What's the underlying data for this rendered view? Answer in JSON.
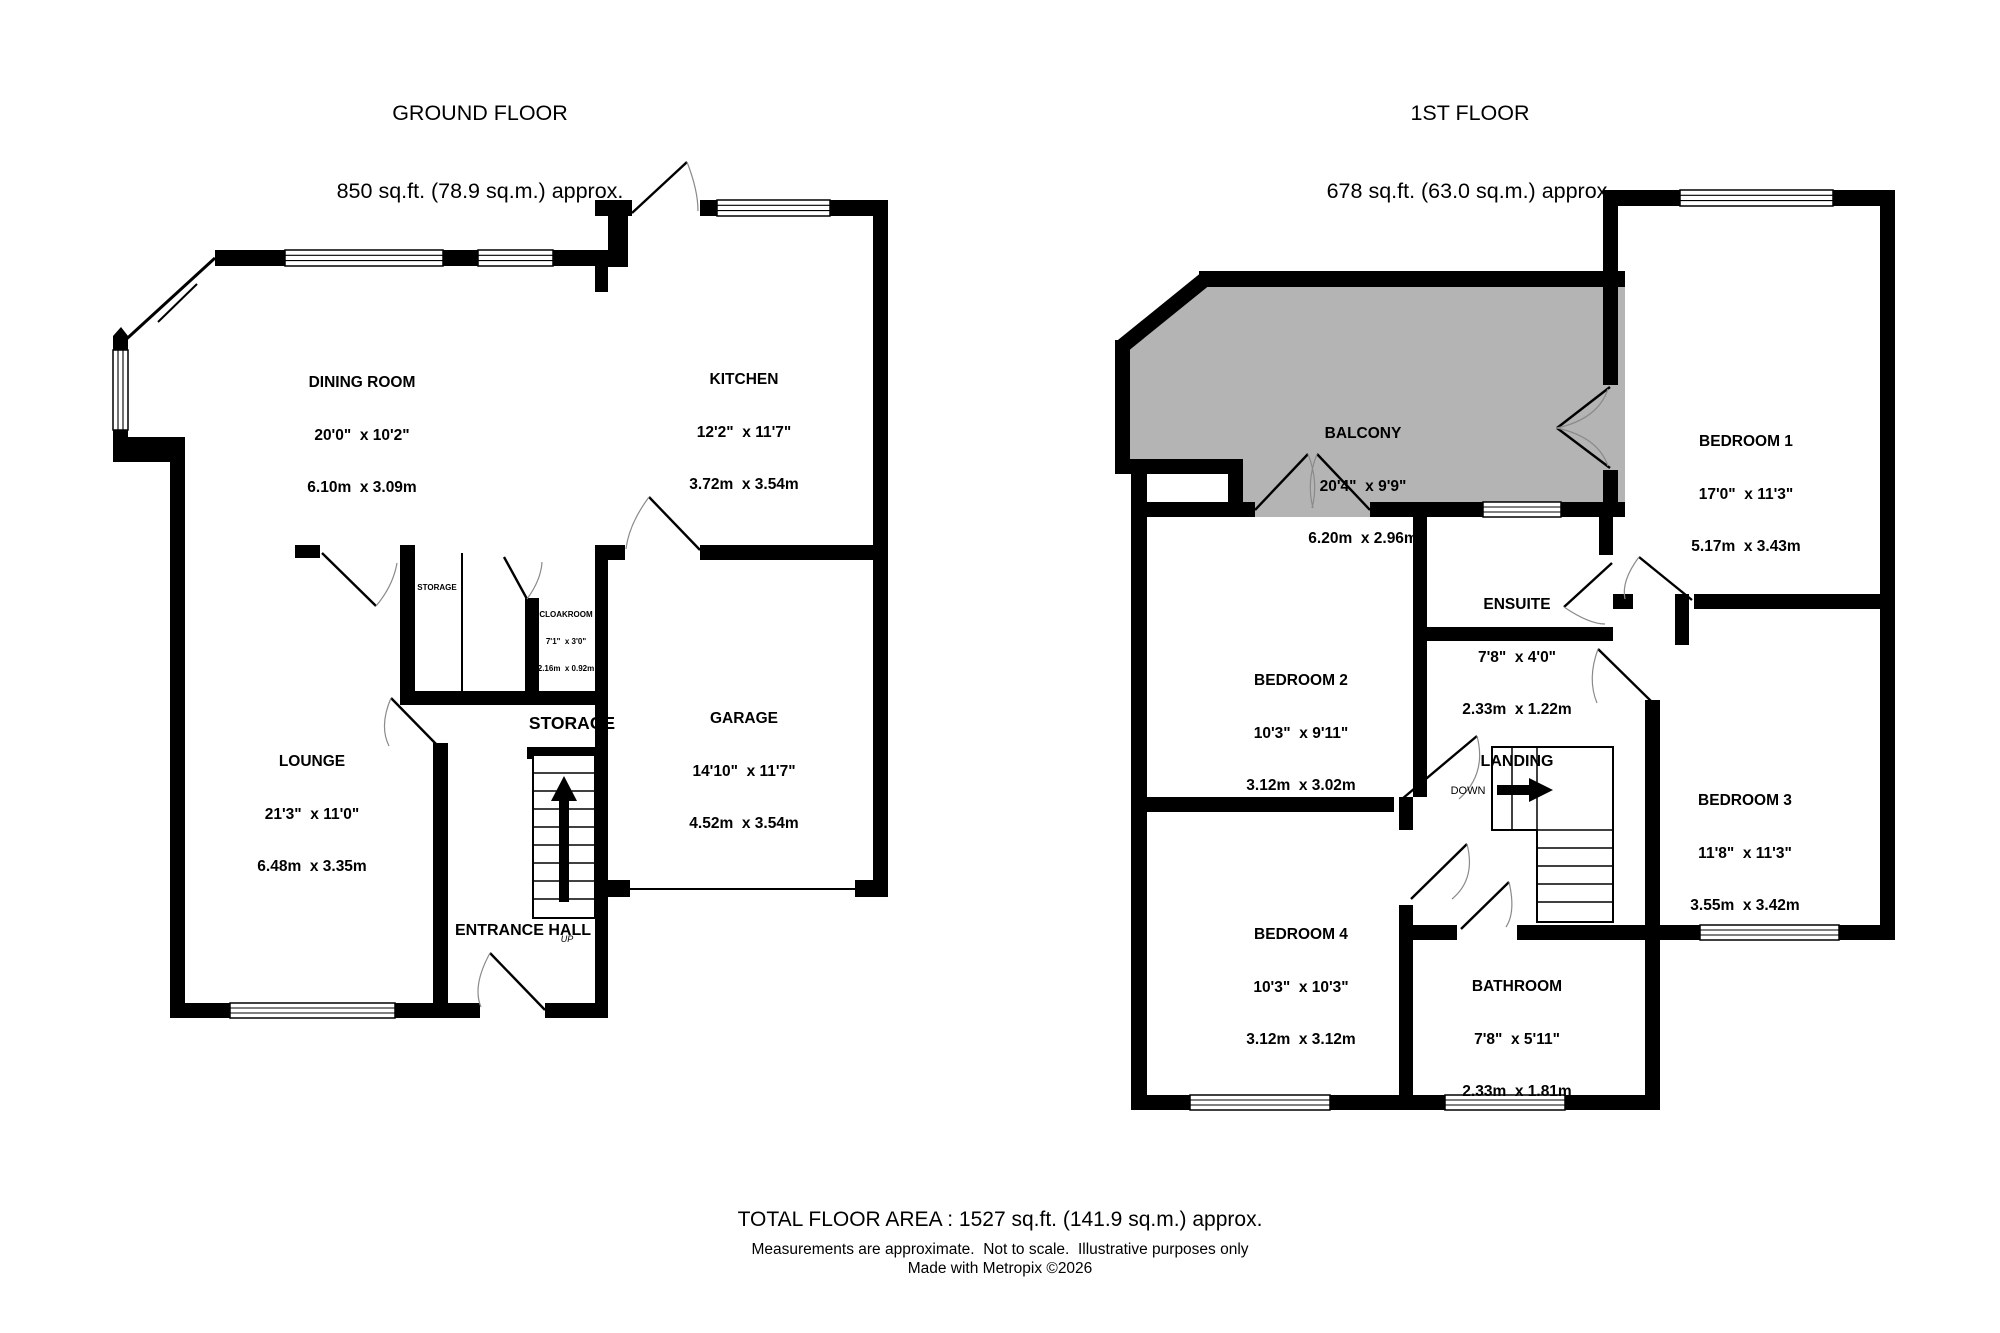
{
  "colors": {
    "walls": "#000000",
    "balcony": "#b4b4b4",
    "background": "#ffffff"
  },
  "ground_floor": {
    "title": "GROUND FLOOR",
    "area": "850 sq.ft. (78.9 sq.m.) approx.",
    "rooms": [
      {
        "name": "DINING ROOM",
        "imperial": "20'0\"  x 10'2\"",
        "metric": "6.10m  x 3.09m"
      },
      {
        "name": "KITCHEN",
        "imperial": "12'2\"  x 11'7\"",
        "metric": "3.72m  x 3.54m"
      },
      {
        "name": "LOUNGE",
        "imperial": "21'3\"  x 11'0\"",
        "metric": "6.48m  x 3.35m"
      },
      {
        "name": "GARAGE",
        "imperial": "14'10\"  x 11'7\"",
        "metric": "4.52m  x 3.54m"
      },
      {
        "name": "CLOAKROOM",
        "imperial": "7'1\"  x 3'0\"",
        "metric": "2.16m  x 0.92m"
      }
    ],
    "labels": {
      "storage_small": "STORAGE",
      "storage_large": "STORAGE",
      "entrance_hall": "ENTRANCE HALL",
      "up": "UP"
    }
  },
  "first_floor": {
    "title": "1ST FLOOR",
    "area": "678 sq.ft. (63.0 sq.m.) approx.",
    "rooms": [
      {
        "name": "BALCONY",
        "imperial": "20'4\"  x 9'9\"",
        "metric": "6.20m  x 2.96m"
      },
      {
        "name": "BEDROOM 1",
        "imperial": "17'0\"  x 11'3\"",
        "metric": "5.17m  x 3.43m"
      },
      {
        "name": "ENSUITE",
        "imperial": "7'8\"  x 4'0\"",
        "metric": "2.33m  x 1.22m"
      },
      {
        "name": "BEDROOM 2",
        "imperial": "10'3\"  x 9'11\"",
        "metric": "3.12m  x 3.02m"
      },
      {
        "name": "BEDROOM 3",
        "imperial": "11'8\"  x 11'3\"",
        "metric": "3.55m  x 3.42m"
      },
      {
        "name": "BEDROOM 4",
        "imperial": "10'3\"  x 10'3\"",
        "metric": "3.12m  x 3.12m"
      },
      {
        "name": "BATHROOM",
        "imperial": "7'8\"  x 5'11\"",
        "metric": "2.33m  x 1.81m"
      }
    ],
    "labels": {
      "landing": "LANDING",
      "down": "DOWN"
    }
  },
  "footer": {
    "total": "TOTAL FLOOR AREA : 1527 sq.ft. (141.9 sq.m.) approx.",
    "disclaimer": "Measurements are approximate.  Not to scale.  Illustrative purposes only",
    "credit": "Made with Metropix ©2026"
  }
}
